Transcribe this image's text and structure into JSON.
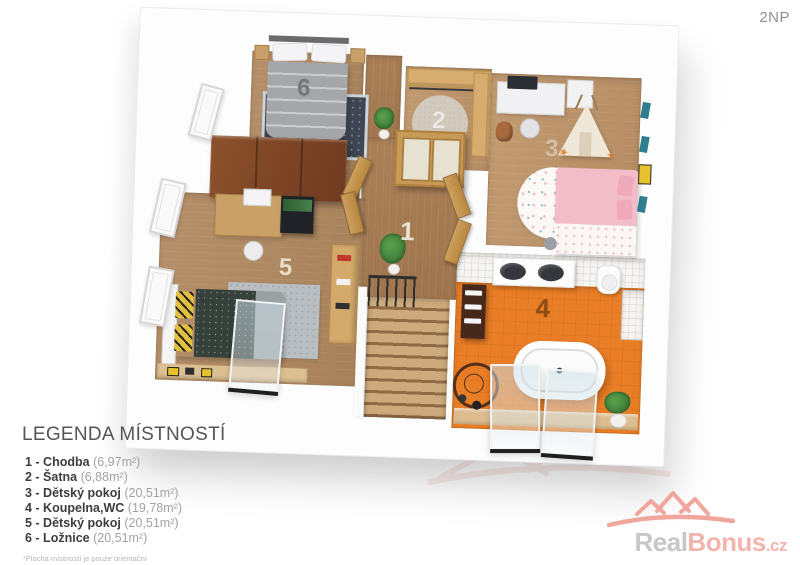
{
  "floor_label": "2NP",
  "plan": {
    "rooms": [
      "1",
      "2",
      "3",
      "4",
      "5",
      "6"
    ]
  },
  "legend": {
    "title": "LEGENDA MÍSTNOSTÍ",
    "entries": [
      {
        "label": "1 - Chodba",
        "area": "(6,97m²)"
      },
      {
        "label": "2 - Šatna",
        "area": "(6,88m²)"
      },
      {
        "label": "3 - Dětský pokoj",
        "area": "(20,51m²)"
      },
      {
        "label": "4 - Koupelna,WC",
        "area": "(19,78m²)"
      },
      {
        "label": "5 - Dětský pokoj",
        "area": "(20,51m²)"
      },
      {
        "label": "6 - Ložnice",
        "area": "(20,51m²)"
      }
    ],
    "footnote": "*Plocha místností je pouze orientační"
  },
  "logo": {
    "real": "Real",
    "bonus": "Bonus",
    "tld": ".cz"
  },
  "palette": {
    "wood_floor": "#B08A63",
    "hall_wood": "#A67E55",
    "wardrobe_wood": "#7C4426",
    "bathroom_orange": "#EA7E26",
    "pink_bed": "#F2B9C6",
    "teal_accent": "#2E7E90",
    "logo_red": "#F2A79E",
    "logo_gray": "#C7C7C7",
    "wall_white": "#FDFDFD"
  }
}
